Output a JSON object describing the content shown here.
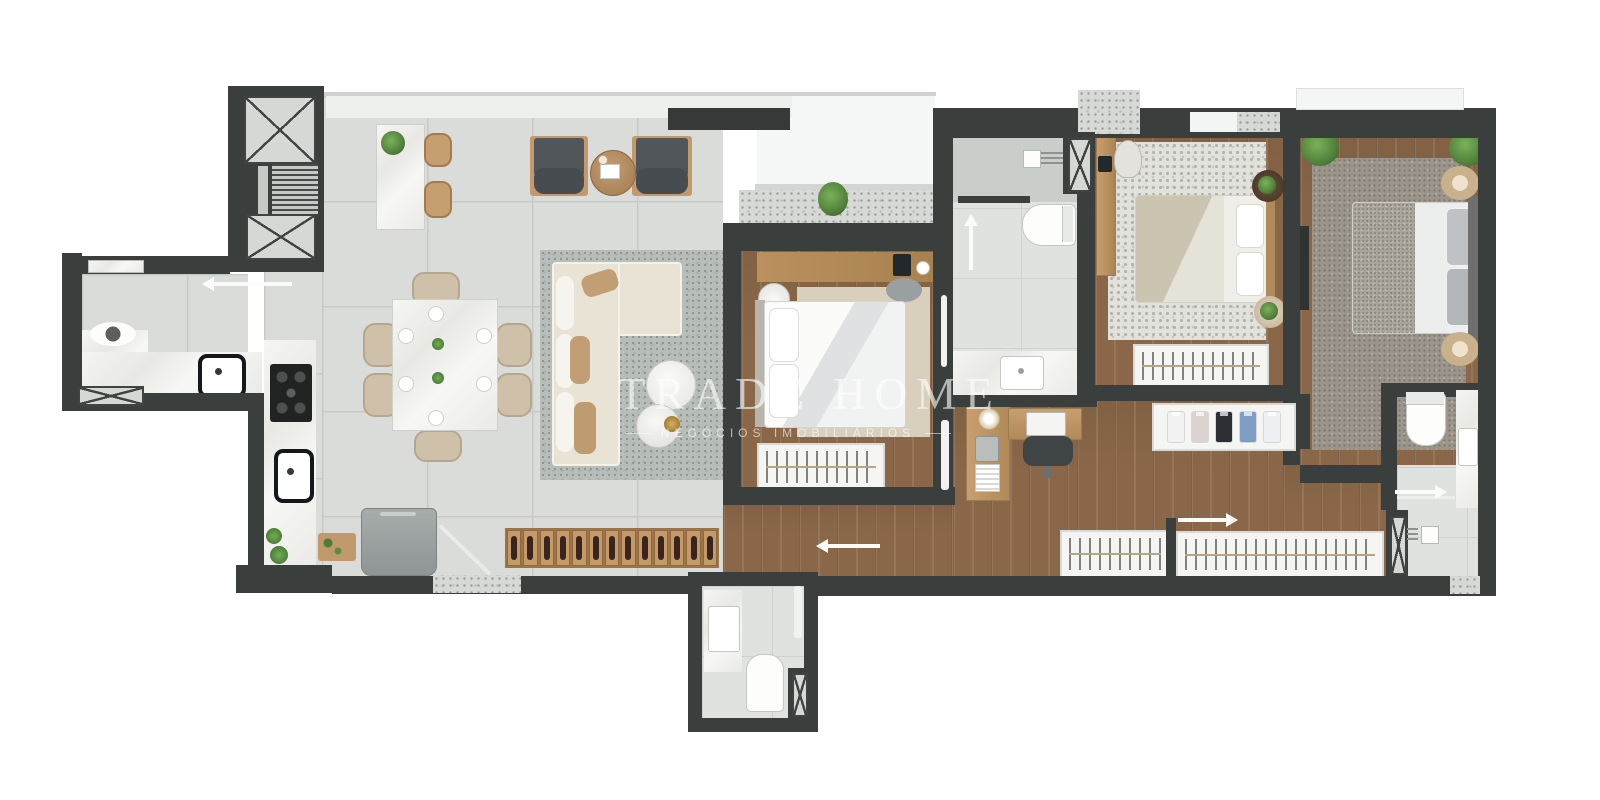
{
  "watermark": {
    "title": "TRADE HOME",
    "subtitle": "NEGÓCIOS IMOBILIÁRIOS"
  },
  "palette": {
    "background": "#ffffff",
    "wall": "#3a3f3e",
    "tile": "#d9dcd9",
    "tile_grout": "#c7cbc7",
    "wood_floor": "#8a6748",
    "marble": "#f2f2f0",
    "terrace": "#f5f7f6",
    "plant_green": "#4f7d38",
    "sofa_cream": "#e9e3d5",
    "pillow_tan": "#c29e74",
    "armchair_gray": "#51565a",
    "chair_beige": "#cfc1a9",
    "rug_living": "#b7bdb8",
    "rug_bedroom1": "#d8cfbc",
    "rug_bedroom3": "#9b958b",
    "wood_furniture": "#b78d5f",
    "appliance_black": "#1f2322",
    "appliance_gray": "#9aa0a0"
  },
  "wine_rack": {
    "bottle_count": 13
  },
  "closet_shelf": {
    "shirt_colors": [
      "#f2f2f2",
      "#ddd3cf",
      "#2c2f33",
      "#7f9ec6",
      "#eef1f3"
    ]
  }
}
